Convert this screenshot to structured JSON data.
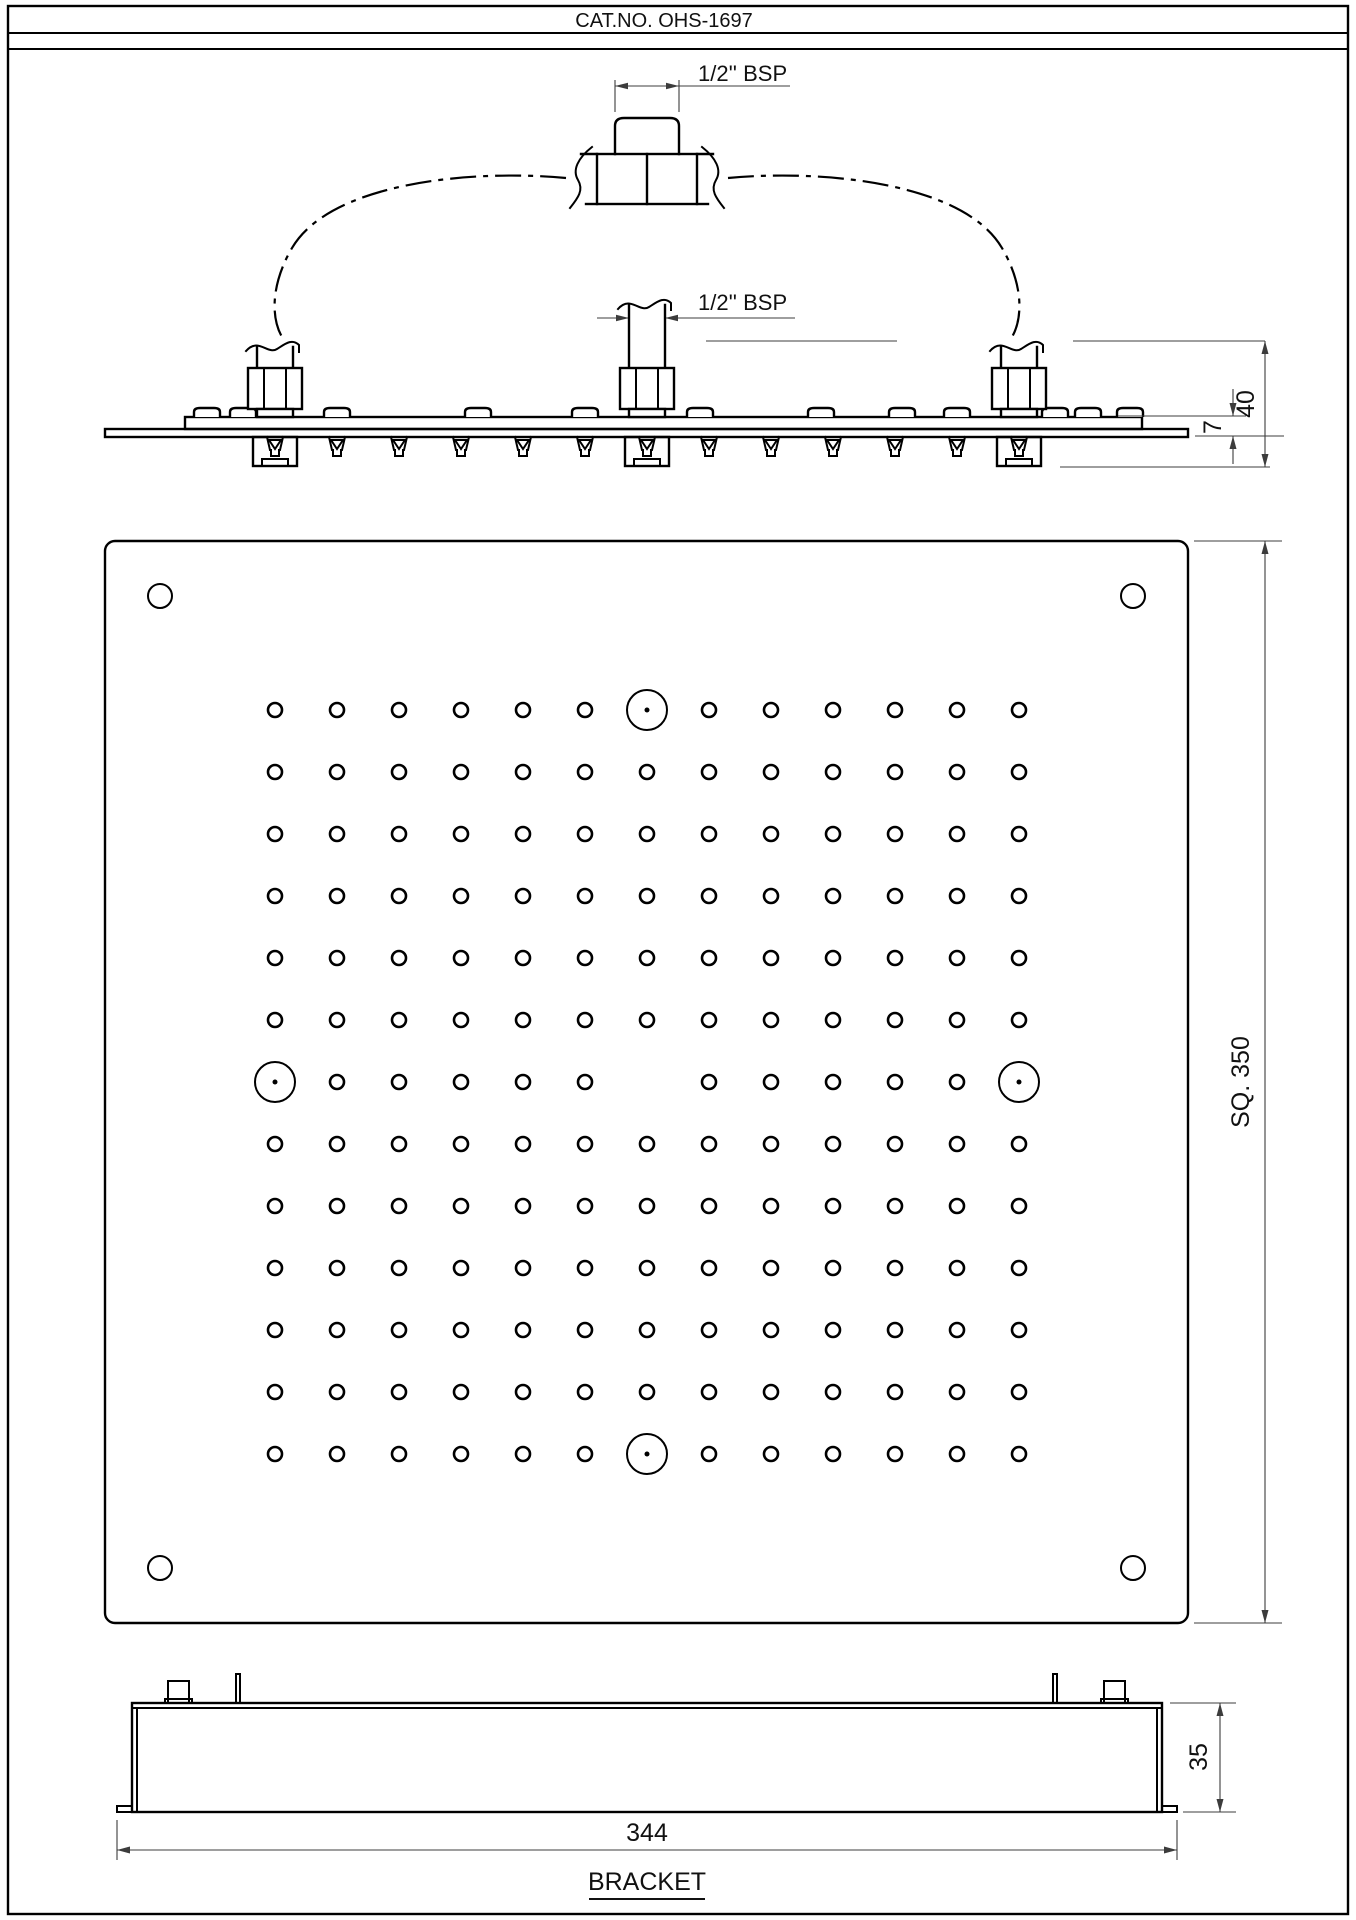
{
  "page": {
    "title": "CAT.NO. OHS-1697",
    "background": "#ffffff",
    "line_color": "#000000",
    "dim_color": "#3c3c3c"
  },
  "elevation": {
    "tee_thread_label": "1/2'' BSP",
    "inlet_thread_label": "1/2'' BSP",
    "overall_height_dim": "40",
    "plate_thickness_dim": "7",
    "connectors": [
      {
        "x": 275,
        "type": "side"
      },
      {
        "x": 647,
        "type": "center"
      },
      {
        "x": 1019,
        "type": "side"
      }
    ],
    "bump_xs": [
      207,
      243,
      337,
      478,
      585,
      700,
      821,
      902,
      957,
      1055,
      1088,
      1130
    ],
    "nozzle_xs": [
      275,
      337,
      399,
      461,
      523,
      585,
      647,
      709,
      771,
      833,
      895,
      957,
      1019
    ]
  },
  "face": {
    "square_dim": "SQ. 350",
    "grid": {
      "rows": 13,
      "cols": 13,
      "spacing": 62,
      "center_x": 647,
      "center_y": 1082,
      "small_r": 7,
      "large_r": 20,
      "dot_r": 2.5
    },
    "large_holes": [
      [
        1,
        7
      ],
      [
        7,
        1
      ],
      [
        7,
        13
      ],
      [
        13,
        7
      ]
    ],
    "omitted_holes": [
      [
        7,
        7
      ]
    ],
    "corner_holes": {
      "inset": 55,
      "r": 12
    }
  },
  "bracket": {
    "caption": "BRACKET",
    "width_dim": "344",
    "height_dim": "35"
  }
}
